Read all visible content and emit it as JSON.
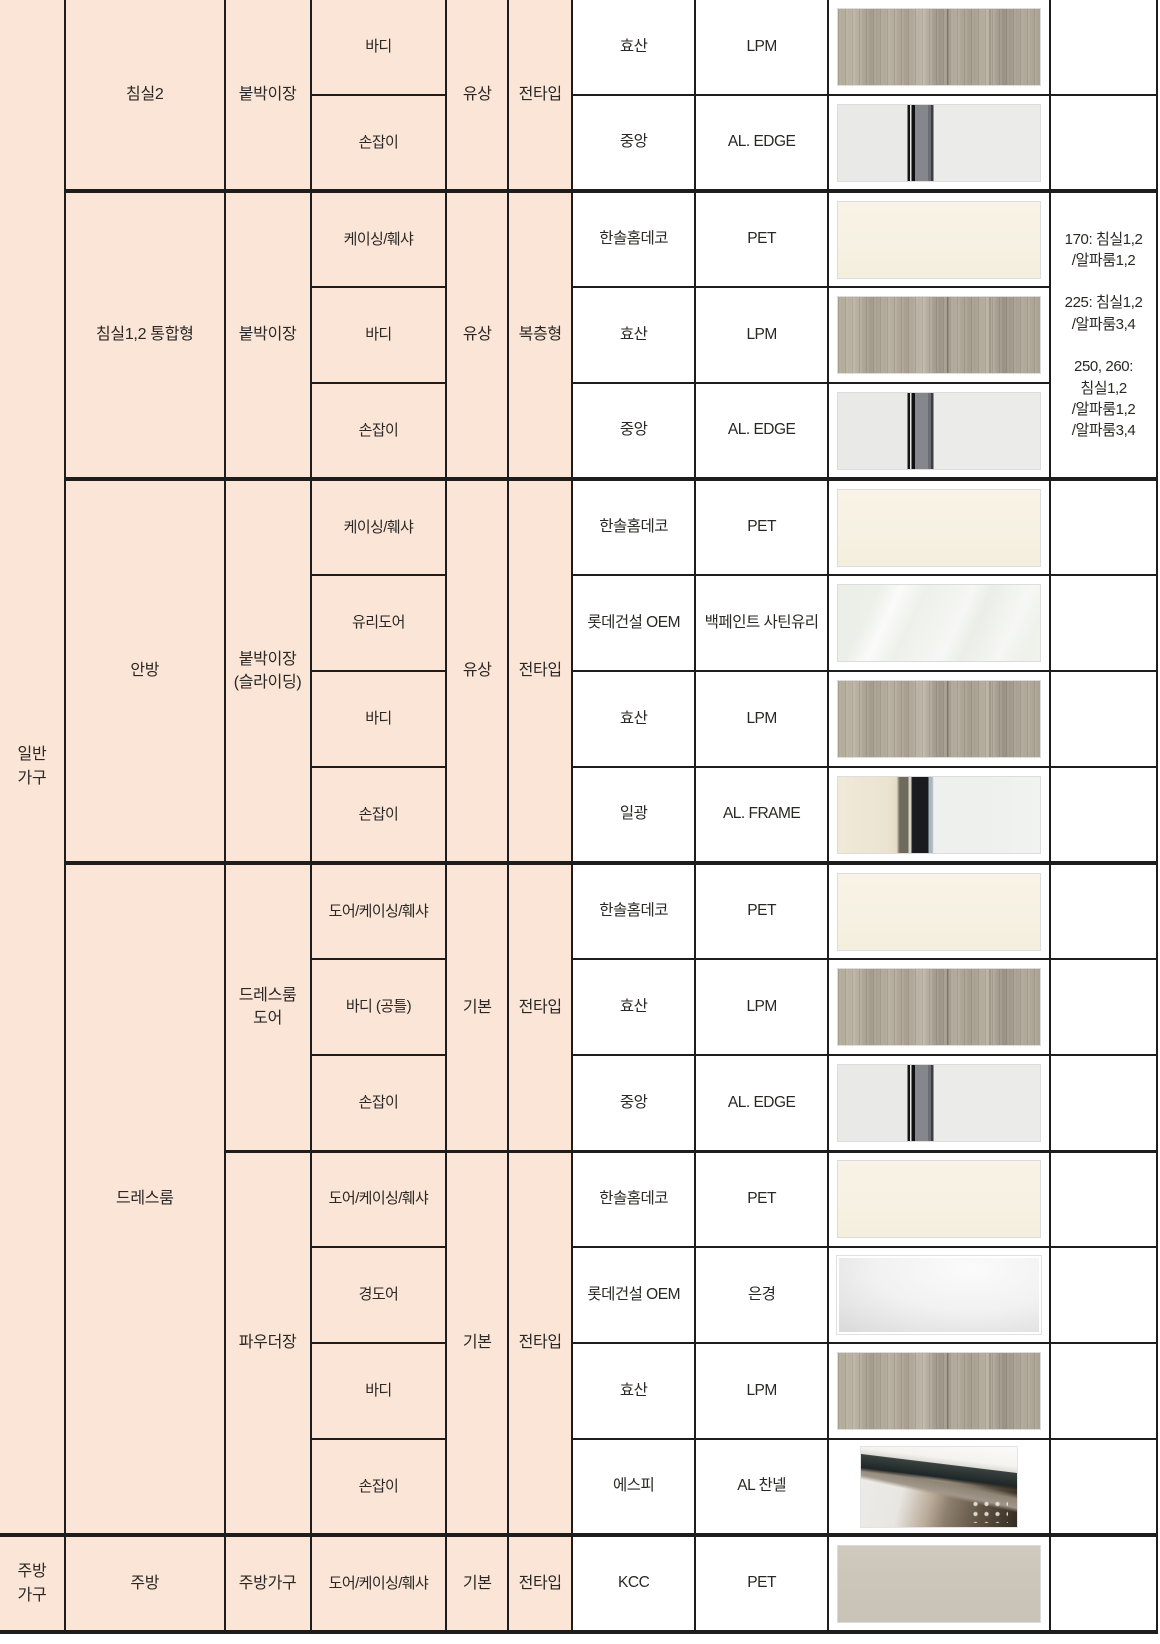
{
  "palette": {
    "cell_fill_pink": "#fbe5d6",
    "grid_border": "#1d1d1d",
    "text": "#2a2826",
    "swatch_cream": "#f6f1e2",
    "swatch_greige": "#ccc6ba"
  },
  "categories": {
    "general": "일반\n가구",
    "kitchen": "주방\n가구"
  },
  "rooms": [
    {
      "name": "침실2",
      "sections": [
        {
          "furniture": "붙박이장",
          "price": "유상",
          "scope": "전타입",
          "items": [
            {
              "part": "바디",
              "maker": "효산",
              "material": "LPM",
              "swatch": "wood"
            },
            {
              "part": "손잡이",
              "maker": "중앙",
              "material": "AL. EDGE",
              "swatch": "al-edge"
            }
          ]
        }
      ]
    },
    {
      "name": "침실1,2 통합형",
      "sections": [
        {
          "furniture": "붙박이장",
          "price": "유상",
          "scope": "복층형",
          "note": "170: 침실1,2\n/알파룸1,2\n\n225: 침실1,2\n/알파룸3,4\n\n250, 260:\n침실1,2\n/알파룸1,2\n/알파룸3,4",
          "items": [
            {
              "part": "케이싱/훼샤",
              "maker": "한솔홈데코",
              "material": "PET",
              "swatch": "cream"
            },
            {
              "part": "바디",
              "maker": "효산",
              "material": "LPM",
              "swatch": "wood"
            },
            {
              "part": "손잡이",
              "maker": "중앙",
              "material": "AL. EDGE",
              "swatch": "al-edge"
            }
          ]
        }
      ]
    },
    {
      "name": "안방",
      "sections": [
        {
          "furniture": "붙박이장\n(슬라이딩)",
          "price": "유상",
          "scope": "전타입",
          "items": [
            {
              "part": "케이싱/훼샤",
              "maker": "한솔홈데코",
              "material": "PET",
              "swatch": "cream"
            },
            {
              "part": "유리도어",
              "maker": "롯데건설 OEM",
              "material": "백페인트 사틴유리",
              "swatch": "satin-glass"
            },
            {
              "part": "바디",
              "maker": "효산",
              "material": "LPM",
              "swatch": "wood"
            },
            {
              "part": "손잡이",
              "maker": "일광",
              "material": "AL. FRAME",
              "swatch": "al-frame"
            }
          ]
        }
      ]
    },
    {
      "name": "드레스룸",
      "sections": [
        {
          "furniture": "드레스룸\n도어",
          "price": "기본",
          "scope": "전타입",
          "items": [
            {
              "part": "도어/케이싱/훼샤",
              "maker": "한솔홈데코",
              "material": "PET",
              "swatch": "cream"
            },
            {
              "part": "바디 (공틀)",
              "maker": "효산",
              "material": "LPM",
              "swatch": "wood"
            },
            {
              "part": "손잡이",
              "maker": "중앙",
              "material": "AL. EDGE",
              "swatch": "al-edge"
            }
          ]
        },
        {
          "furniture": "파우더장",
          "price": "기본",
          "scope": "전타입",
          "items": [
            {
              "part": "도어/케이싱/훼샤",
              "maker": "한솔홈데코",
              "material": "PET",
              "swatch": "cream"
            },
            {
              "part": "경도어",
              "maker": "롯데건설 OEM",
              "material": "은경",
              "swatch": "mirror"
            },
            {
              "part": "바디",
              "maker": "효산",
              "material": "LPM",
              "swatch": "wood"
            },
            {
              "part": "손잡이",
              "maker": "에스피",
              "material": "AL 찬넬",
              "swatch": "al-channel"
            }
          ]
        }
      ]
    },
    {
      "name": "주방",
      "sections": [
        {
          "furniture": "주방가구",
          "price": "기본",
          "scope": "전타입",
          "items": [
            {
              "part": "도어/케이싱/훼샤",
              "maker": "KCC",
              "material": "PET",
              "swatch": "greige"
            }
          ]
        }
      ]
    }
  ]
}
